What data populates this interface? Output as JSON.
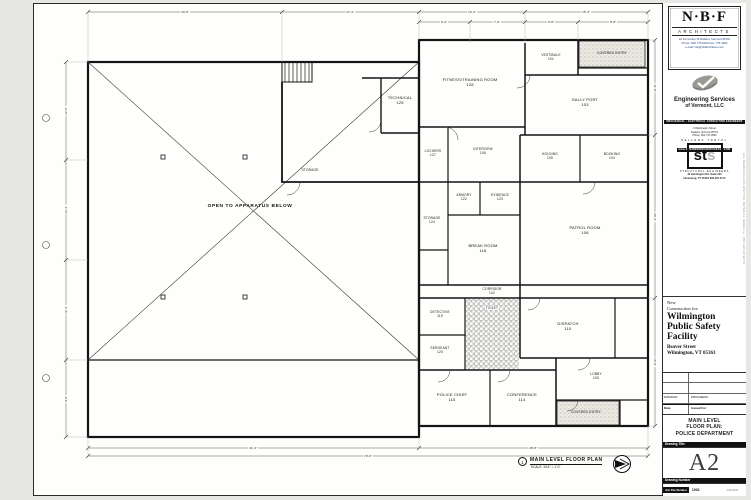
{
  "plan": {
    "note": {
      "number": "1",
      "title": "MAIN LEVEL FLOOR PLAN",
      "scale": "SCALE: 3/16\" = 1'-0\""
    },
    "rooms": {
      "apparatus": "OPEN TO APPARATUS BELOW",
      "mezz_storage": "STORAGE",
      "technical": "TECHNICAL\n125",
      "fitness": "FITNESS/TRAINING ROOM\n128",
      "vestibule": "VESTIBULE\n101",
      "covered_entry_top": "COVERED ENTRY",
      "sally_port": "SALLY PORT\n103",
      "lockers": "LOCKERS\n127",
      "interview": "INTERVIEW\n106",
      "holding": "HOLDING\n105",
      "booking": "BOOKING\n104",
      "storage": "STORAGE\n124",
      "armory": "ARMORY\n122",
      "evidence": "EVIDENCE\n123",
      "break_room": "BREAK ROOM\n118",
      "patrol": "PATROL ROOM\n108",
      "corridor": "CORRIDOR\n102",
      "detective": "DETECTIVE\n119",
      "sergeant": "SERGEANT\n120",
      "toilet": "TOILET",
      "dispatch": "DISPATCH\n110",
      "lobby": "LOBBY\n100",
      "police_chief": "POLICE CHIEF\n115",
      "conference": "CONFERENCE\n114",
      "covered_entry_bottom": "COVERED ENTRY"
    },
    "dims": {
      "t1": "24'-8\"",
      "t2": "17'-4\"",
      "t3": "13'-4\"",
      "t4": "15'-4\"",
      "t5": "6'-4\"",
      "t6": "7'-0\"",
      "t7": "6'-8\"",
      "t8": "8'-8\"",
      "l1": "12'-0\"",
      "l2": "12'-4\"",
      "l3": "12'-4\"",
      "l4": "9'-8\"",
      "r1": "11'-8\"",
      "r2": "20'-4\"",
      "r3": "16'-0\"",
      "b1": "41'-4\"",
      "b2": "28'-8\"",
      "b3": "70'-0\""
    }
  },
  "titleblock": {
    "nbf": {
      "name": "N·B·F",
      "type": "ARCHITECTS",
      "address": "24 1/2 Center St Rutland, Vermont 05701",
      "phone": "Phone: 802 775-0160    Fax: 775-4460",
      "email": "e-mail:  info@nbfarchitects.com"
    },
    "esv": {
      "title": "Engineering Services",
      "subtitle": "of Vermont, LLC",
      "bar1": "MECHANICAL · ELECTRICAL CONSULTING ENGINEERS",
      "line1": "6 Washington Street",
      "line2": "Rutland, Vermont 05701",
      "line3": "Phone: 802 747-0560",
      "bar2": "www.ENGINEERINGSERVICESVT.COM"
    },
    "sts": {
      "header": "SELLERS TRETOL",
      "logo_st": "st",
      "logo_s": "s",
      "line1": "STRUCTURAL ENGINEERS",
      "addr1": "46 Huntington Rd.  Suite 201",
      "addr2": "Hinesburg, VT 05461   802.497.1174"
    },
    "project": {
      "intro": "New\nConstruction for:",
      "name": "Wilmington\nPublic Safety\nFacility",
      "address": "Beaver Street\nWilmington, VT 05363"
    },
    "revisions": {
      "date": "6/26/2020",
      "issued": "PROGRESS",
      "date_label": "Date",
      "issued_label": "Issued For"
    },
    "drawing_title": {
      "title": "MAIN LEVEL\nFLOOR PLAN:\nPOLICE DEPARTMENT",
      "label": "Drawing Title"
    },
    "drawing_number": {
      "number": "A2",
      "label": "Drawing Number"
    },
    "job": {
      "label": "Job File Number",
      "number": "1902",
      "stamp": "6/26/2020"
    },
    "side_note": "ALL DRAWINGS AND WRITTEN MATERIAL HEREIN © NBF ARCHITECTS"
  }
}
